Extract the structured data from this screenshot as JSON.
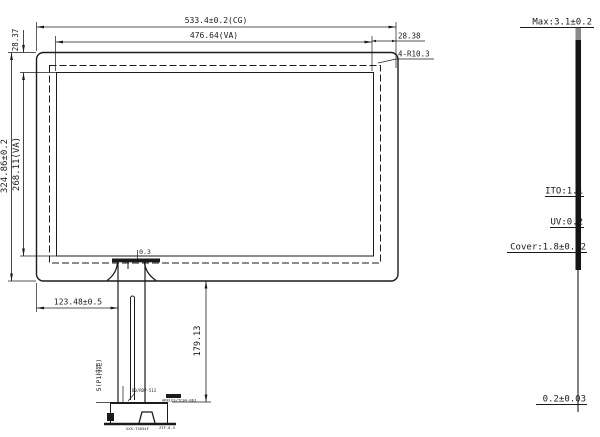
{
  "drawing": {
    "title": "touch-panel-outline-drawing",
    "top": {
      "cg_width": "533.4±0.2(CG)",
      "va_width": "476.64(VA)",
      "right_border": "28.38",
      "corner_radius": "4-R10.3",
      "top_border": "28.37"
    },
    "left": {
      "cg_height": "324.86±0.2",
      "va_height": "268.11(VA)"
    },
    "bottom": {
      "tail_offset": "123.48±0.5",
      "tail_gap": "0.3",
      "tail_length": "179.13",
      "pin_pitch": "5(P1排距)",
      "connector_label_1": "B0/RDP-513",
      "connector_label_2": "ARKLES/TC04-06J",
      "connector_label_3": "XXX-T3034F",
      "connector_label_4": "ZIF-0.5"
    },
    "stack": {
      "max": "Max:3.1±0.2",
      "ito": "ITO:1.1",
      "uv": "UV:0.2",
      "cover": "Cover:1.8±0.02",
      "fpc": "0.2±0.03"
    },
    "colors": {
      "line": "#1b1b1b",
      "stack_top_segment": "#8a8a8a",
      "background": "#ffffff"
    }
  }
}
